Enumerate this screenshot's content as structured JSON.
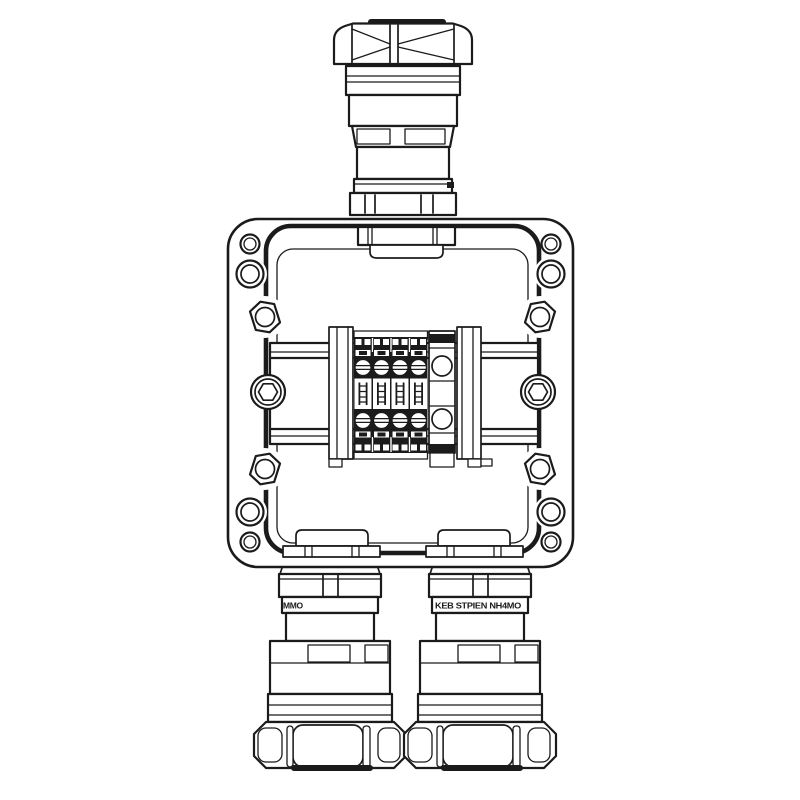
{
  "canvas": {
    "width": 800,
    "height": 800,
    "background": "#ffffff",
    "line_color": "#1b1b1b"
  },
  "drawing": {
    "type": "technical-line-drawing"
  },
  "markings": {
    "left_gland": "MMO",
    "right_gland": "KEB STPIEN NH4MO"
  },
  "parts": [
    "top-cable-gland",
    "enclosure-lid",
    "mounting-holes",
    "lid-screws",
    "cover-bolts",
    "gasket-groove",
    "din-rail",
    "rail-mount-screws",
    "terminal-blocks",
    "terminal-end-stop-left",
    "terminal-end-stop-right",
    "terminal-end-block",
    "cable-entry-bosses",
    "bottom-cable-gland-left",
    "bottom-cable-gland-right"
  ]
}
